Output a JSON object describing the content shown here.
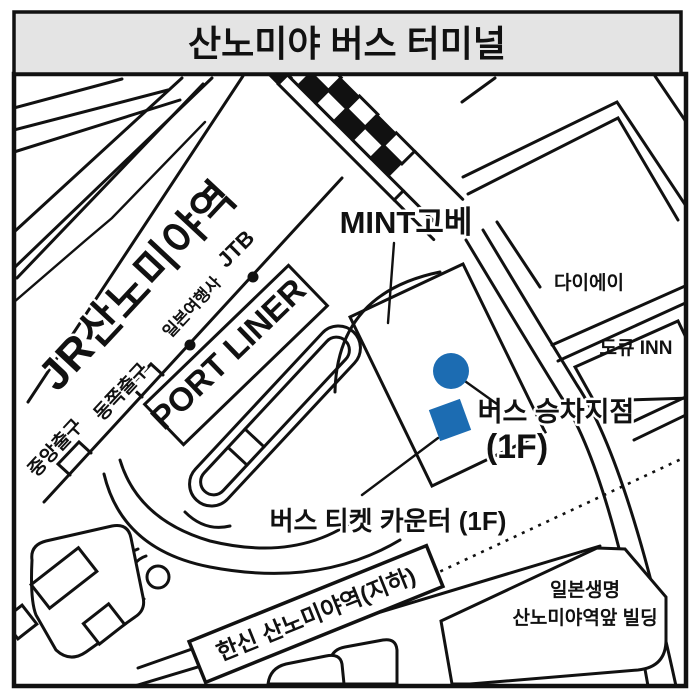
{
  "title": "산노미야 버스 터미널",
  "colors": {
    "marker_blue": "#1C6CB2",
    "title_bg": "#E4E4E4",
    "line_black": "#111111"
  },
  "labels": {
    "jr_station": "JR산노미야역",
    "central_exit": "중앙출구",
    "east_exit": "동쪽출구",
    "travel_agency": "일본여행사",
    "jtb": "JTB",
    "port_liner": "PORT LINER",
    "mint_kobe": "MINT고베",
    "daiei": "다이에이",
    "tokyu_inn": "도큐 INN",
    "bus_boarding": "버스 승차지점",
    "bus_boarding_floor": "(1F)",
    "ticket_counter": "버스 티켓 카운터 (1F)",
    "hanshin_station": "한신 산노미야역(지하)",
    "nippon_life_1": "일본생명",
    "nippon_life_2": "산노미야역앞 빌딩"
  }
}
